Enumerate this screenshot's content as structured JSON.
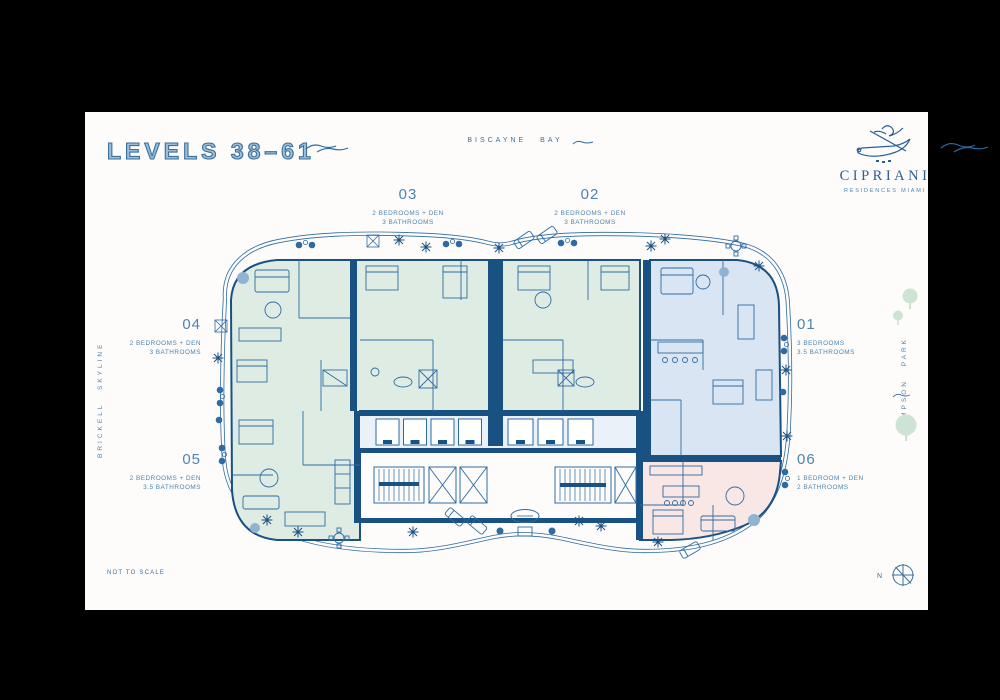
{
  "header": {
    "title": "LEVELS 38–61",
    "bay_label": "BISCAYNE BAY"
  },
  "brand": {
    "name": "CIPRIANI",
    "tagline": "RESIDENCES MIAMI",
    "logo_icon": "gondola-icon"
  },
  "units": [
    {
      "number": "01",
      "line1": "3 BEDROOMS",
      "line2": "3.5 BATHROOMS",
      "fill": "#d9e5f3"
    },
    {
      "number": "02",
      "line1": "2 BEDROOMS + DEN",
      "line2": "3 BATHROOMS",
      "fill": "#dfece3"
    },
    {
      "number": "03",
      "line1": "2 BEDROOMS + DEN",
      "line2": "3 BATHROOMS",
      "fill": "#dfece3"
    },
    {
      "number": "04",
      "line1": "2 BEDROOMS + DEN",
      "line2": "3 BATHROOMS",
      "fill": "#dfece3"
    },
    {
      "number": "05",
      "line1": "2 BEDROOMS + DEN",
      "line2": "3.5 BATHROOMS",
      "fill": "#dfece3"
    },
    {
      "number": "06",
      "line1": "1 BEDROOM + DEN",
      "line2": "2 BATHROOMS",
      "fill": "#f8e7e4"
    }
  ],
  "context_labels": {
    "left": "BRICKELL SKYLINE",
    "right": "SIMPSON PARK"
  },
  "footer": {
    "scale_note": "NOT TO SCALE",
    "compass_letter": "N"
  },
  "colors": {
    "background": "#000000",
    "canvas": "#fdfcfa",
    "accent_blue": "#2e6ba3",
    "wall_navy": "#1a5183",
    "label_blue": "#4f83b0",
    "unit_green": "#dfece3",
    "unit_blue": "#d9e5f3",
    "unit_pink": "#f8e7e4",
    "corridor_tint": "#eaf1f8",
    "tree_green": "#cde3d4"
  }
}
